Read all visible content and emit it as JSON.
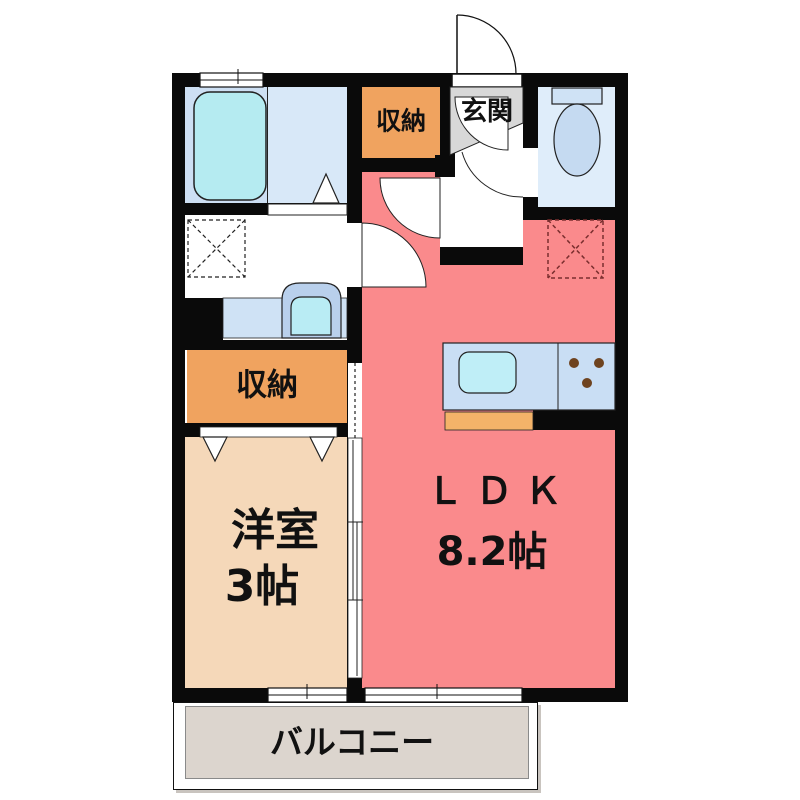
{
  "floorplan": {
    "rooms": {
      "ldk": {
        "label": "ＬＤＫ",
        "size": "8.2帖"
      },
      "western_room": {
        "label": "洋室",
        "size": "3帖"
      },
      "storage_top": {
        "label": "収納"
      },
      "storage_mid": {
        "label": "収納"
      },
      "entrance": {
        "label": "玄関"
      },
      "balcony": {
        "label": "バルコニー"
      }
    },
    "fixtures": {
      "bathtub": "bathtub",
      "toilet": "toilet",
      "washbasin": "washbasin",
      "kitchen_sink": "kitchen-sink-with-stove",
      "washer_space": "washing-machine-space (dashed)",
      "fridge_space": "refrigerator-space (dashed)"
    },
    "colors": {
      "ldk_pink": "#fa8a8c",
      "western_room_peach": "#f5d8b9",
      "storage_orange": "#f0a35f",
      "bathroom_blue": "#cddff3",
      "bathroom_blue_light": "#d8e8f8",
      "toilet_blue": "#dfedfa",
      "tub_cyan": "#b5ebf1",
      "counter_blue": "#c9def4",
      "sink_cyan": "#bfeef7",
      "counter_orange": "#f4b369",
      "entrance_gray": "#d8d8d8",
      "balcony_gray": "#dcd5ce",
      "wall_black": "#0a0a0a",
      "fridge_dash_red": "#7a2e2e"
    }
  }
}
